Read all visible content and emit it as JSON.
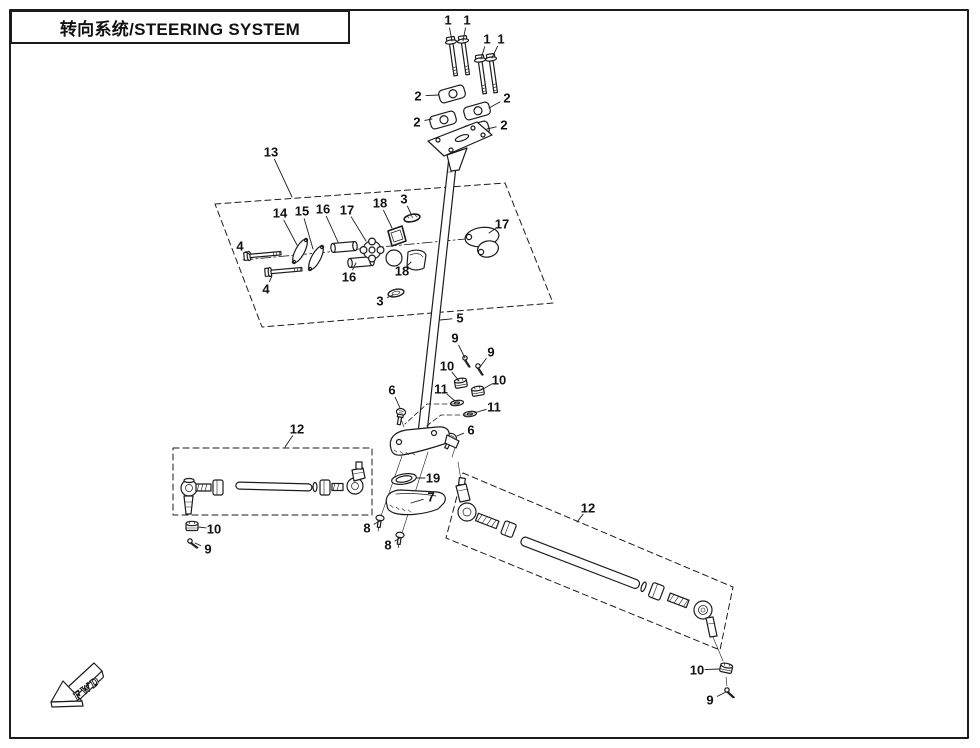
{
  "page": {
    "title": "转向系统/STEERING SYSTEM",
    "title_zh": "转向系统",
    "title_en": "STEERING SYSTEM",
    "fwd_label": "FWD",
    "colors": {
      "ink": "#1c1c1c",
      "background": "#ffffff",
      "border": "#1b1b1b"
    }
  },
  "diagram": {
    "description": "Exploded parts view of steering system: handlebar clamps, steering column, column holders and tie rod assemblies",
    "callouts": [
      {
        "n": "1",
        "x": 448,
        "y": 20,
        "tx": 452,
        "ty": 41
      },
      {
        "n": "1",
        "x": 467,
        "y": 20,
        "tx": 463,
        "ty": 41
      },
      {
        "n": "1",
        "x": 487,
        "y": 39,
        "tx": 481,
        "ty": 59
      },
      {
        "n": "1",
        "x": 501,
        "y": 39,
        "tx": 492,
        "ty": 58
      },
      {
        "n": "2",
        "x": 418,
        "y": 96,
        "tx": 439,
        "ty": 95
      },
      {
        "n": "2",
        "x": 507,
        "y": 98,
        "tx": 489,
        "ty": 108
      },
      {
        "n": "2",
        "x": 417,
        "y": 122,
        "tx": 432,
        "ty": 119
      },
      {
        "n": "2",
        "x": 504,
        "y": 125,
        "tx": 487,
        "ty": 129
      },
      {
        "n": "3",
        "x": 404,
        "y": 199,
        "tx": 411,
        "ty": 214
      },
      {
        "n": "3",
        "x": 380,
        "y": 301,
        "tx": 393,
        "ty": 295
      },
      {
        "n": "4",
        "x": 240,
        "y": 246,
        "tx": 250,
        "ty": 255
      },
      {
        "n": "4",
        "x": 266,
        "y": 289,
        "tx": 272,
        "ty": 276
      },
      {
        "n": "5",
        "x": 460,
        "y": 318,
        "tx": 440,
        "ty": 320
      },
      {
        "n": "6",
        "x": 392,
        "y": 390,
        "tx": 400,
        "ty": 408
      },
      {
        "n": "6",
        "x": 471,
        "y": 430,
        "tx": 457,
        "ty": 436
      },
      {
        "n": "7",
        "x": 431,
        "y": 497,
        "tx": 411,
        "ty": 503
      },
      {
        "n": "8",
        "x": 367,
        "y": 528,
        "tx": 380,
        "ty": 521
      },
      {
        "n": "8",
        "x": 388,
        "y": 545,
        "tx": 400,
        "ty": 538
      },
      {
        "n": "9",
        "x": 455,
        "y": 338,
        "tx": 465,
        "ty": 358
      },
      {
        "n": "9",
        "x": 491,
        "y": 352,
        "tx": 480,
        "ty": 367
      },
      {
        "n": "9",
        "x": 208,
        "y": 549,
        "tx": 195,
        "ty": 543
      },
      {
        "n": "9",
        "x": 710,
        "y": 700,
        "tx": 726,
        "ty": 692
      },
      {
        "n": "10",
        "x": 447,
        "y": 366,
        "tx": 459,
        "ty": 381
      },
      {
        "n": "10",
        "x": 499,
        "y": 380,
        "tx": 483,
        "ty": 389
      },
      {
        "n": "10",
        "x": 214,
        "y": 529,
        "tx": 199,
        "ty": 527
      },
      {
        "n": "10",
        "x": 697,
        "y": 670,
        "tx": 719,
        "ty": 669
      },
      {
        "n": "11",
        "x": 441,
        "y": 389,
        "tx": 455,
        "ty": 401
      },
      {
        "n": "11",
        "x": 494,
        "y": 407,
        "tx": 474,
        "ty": 413
      },
      {
        "n": "12",
        "x": 297,
        "y": 429,
        "tx": 285,
        "ty": 447
      },
      {
        "n": "12",
        "x": 588,
        "y": 508,
        "tx": 577,
        "ty": 522
      },
      {
        "n": "13",
        "x": 271,
        "y": 152,
        "tx": 292,
        "ty": 197
      },
      {
        "n": "14",
        "x": 280,
        "y": 213,
        "tx": 297,
        "ty": 245
      },
      {
        "n": "15",
        "x": 302,
        "y": 211,
        "tx": 313,
        "ty": 249
      },
      {
        "n": "16",
        "x": 323,
        "y": 209,
        "tx": 338,
        "ty": 242
      },
      {
        "n": "16",
        "x": 349,
        "y": 277,
        "tx": 356,
        "ty": 263
      },
      {
        "n": "17",
        "x": 347,
        "y": 210,
        "tx": 366,
        "ty": 241
      },
      {
        "n": "17",
        "x": 502,
        "y": 224,
        "tx": 489,
        "ty": 233
      },
      {
        "n": "18",
        "x": 380,
        "y": 203,
        "tx": 392,
        "ty": 228
      },
      {
        "n": "18",
        "x": 402,
        "y": 271,
        "tx": 411,
        "ty": 262
      },
      {
        "n": "19",
        "x": 433,
        "y": 478,
        "tx": 417,
        "ty": 478
      }
    ]
  }
}
